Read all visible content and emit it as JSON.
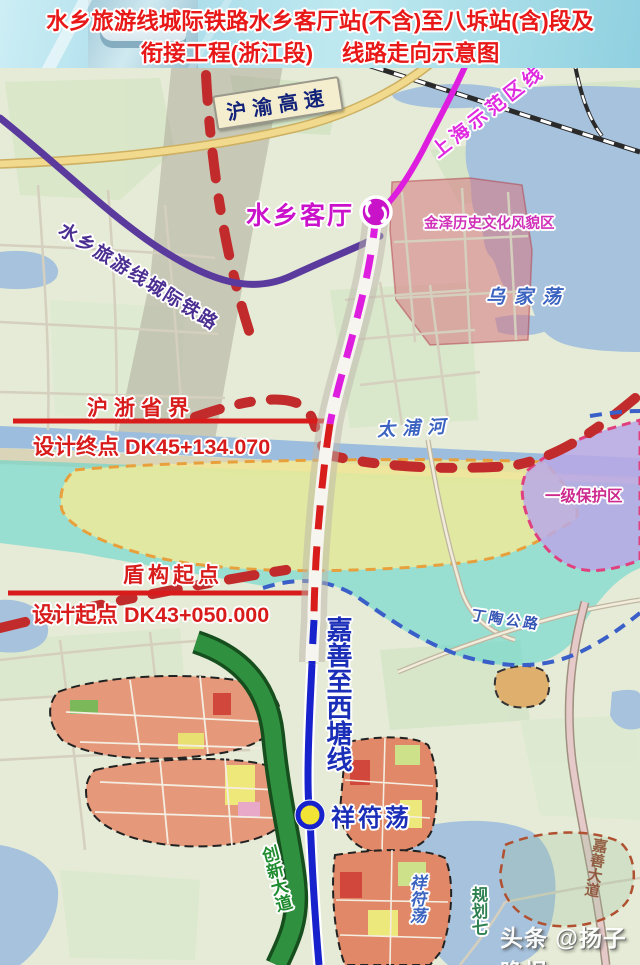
{
  "title": {
    "line1": "水乡旅游线城际铁路水乡客厅站(不含)至八坼站(含)段及",
    "line2": "衔接工程(浙江段)　 线路走向示意图"
  },
  "map": {
    "stations": {
      "shuixiang_keting": "水乡客厅",
      "xiangfudang": "祥符荡"
    },
    "rail_lines": {
      "demo_line": "上海示范区线",
      "intercity": "水乡旅游线城际铁路",
      "jiashan_xitang": "嘉善至西塘线"
    },
    "roads": {
      "expressway": "沪渝高速",
      "dingtao_road": "丁陶公路",
      "chuangxin_avenue": "创新大道",
      "jiashan_avenue": "嘉善大道"
    },
    "waters": {
      "wujiadang": "乌家荡",
      "taipu_river": "太浦河",
      "xiangfudang_lake": "祥符荡"
    },
    "zones": {
      "jinze_area": "金泽历史文化风貌区",
      "protection_zone": "一级保护区",
      "planning_seven": "规划七"
    },
    "annotations": {
      "province_border": "沪浙省界",
      "design_end": "设计终点  DK45+134.070",
      "shield_start": "盾构起点",
      "design_start": "设计起点  DK43+050.000"
    },
    "colors": {
      "title_text": "#e81818",
      "demo_line": "#de1ede",
      "intercity_line": "#5b3a9e",
      "route_dash_red": "#d81c1c",
      "route_blue": "#1822cc",
      "green_road": "#2f9040",
      "red_boundary": "#c22b2b",
      "blue_boundary": "#3a5fc8",
      "protection_fill": "#b9a8e6",
      "cyan_zone": "#60d6cd",
      "yellow_zone": "#f2ea96"
    }
  },
  "watermark": "头条 @扬子晚报"
}
